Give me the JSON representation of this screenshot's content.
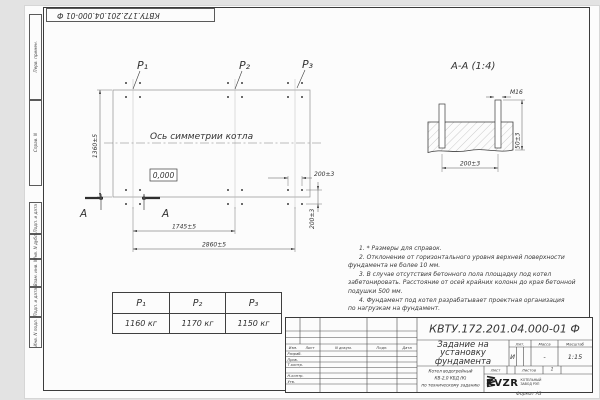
{
  "stamp_top": {
    "text": "КВТУ.172.201.04.000-01 Ф"
  },
  "margin_cells": [
    {
      "label": "Перв. примен."
    },
    {
      "label": "Справ. N"
    },
    {
      "label": "Подп. и дата"
    },
    {
      "label": "Инв. N дубл."
    },
    {
      "label": "Взам. инв. N"
    },
    {
      "label": "Подп. и дата"
    },
    {
      "label": "Инв. N подл."
    }
  ],
  "plan": {
    "p1": "P₁",
    "p2": "P₂",
    "p3": "P₃",
    "axis_label": "Ось симметрии котла",
    "elevation": "0,000",
    "dim_height": "1360±5",
    "dim_span_mid": "1745±5",
    "dim_span_full": "2860±5",
    "dim_bolt_h": "200±3",
    "dim_bolt_v": "200±3",
    "section_letter_left": "А",
    "section_letter_right": "А"
  },
  "section_view": {
    "title": "А-А (1:4)",
    "bolt_label": "M16",
    "dim_width": "200±3",
    "dim_height": "50±3"
  },
  "notes_lines": [
    "1. * Размеры для справок.",
    "2. Отклонение от горизонтального уровня верхней поверхности",
    "фундамента не более 10 мм.",
    "3. В случае отсутствия бетонного пола площадку под котел",
    "забетонировать. Расстояние от осей крайних колонн до края бетонной",
    "подушки 500 мм.",
    "4. Фундамент под котел разрабатывает проектная организация",
    "по нагрузкам на фундамент."
  ],
  "load_table": {
    "headers": [
      "P₁",
      "P₂",
      "P₃"
    ],
    "values": [
      "1160 кг",
      "1170 кг",
      "1150 кг"
    ]
  },
  "title_block": {
    "doc_number": "КВТУ.172.201.04.000-01 Ф",
    "title_line1": "Задание на",
    "title_line2": "установку",
    "title_line3": "фундамента",
    "product_line1": "Котел водогрейный",
    "product_line2": "КВ-2,0 КБД (К)",
    "product_line3": "по техническому заданию",
    "col_izm": "Изм.",
    "col_list": "Лист",
    "col_doc": "N докум.",
    "col_podp": "Подп.",
    "col_data": "Дата",
    "role_razrab": "Разраб.",
    "role_prov": "Пров.",
    "role_tkontr": "Т.контр.",
    "role_nkontr": "Н.контр.",
    "role_utv": "Утв.",
    "lit_label": "Лит.",
    "mass_label": "Масса",
    "scale_label": "Масштаб",
    "lit_value": "И",
    "mass_value": "-",
    "scale_value": "1:15",
    "sheet_label": "Лист",
    "sheets_label": "Листов",
    "sheets_value": "1",
    "logo_text": "KVZR",
    "logo_line1": "КОТЕЛЬНЫЙ",
    "logo_line2": "ЗАВОД РЭП",
    "format_label": "Формат А3"
  }
}
